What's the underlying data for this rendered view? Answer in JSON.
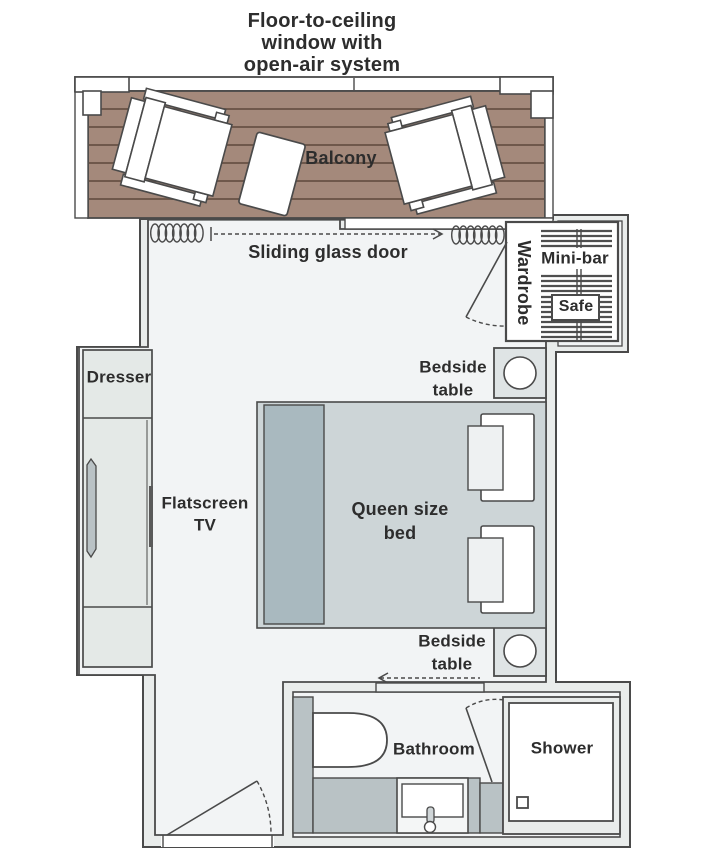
{
  "header": {
    "title_line1": "Floor-to-ceiling",
    "title_line2": "window with",
    "title_line3": "open-air system"
  },
  "labels": {
    "balcony": "Balcony",
    "sliding_door": "Sliding glass door",
    "wardrobe": "Wardrobe",
    "minibar": "Mini-bar",
    "safe": "Safe",
    "dresser": "Dresser",
    "tv_line1": "Flatscreen",
    "tv_line2": "TV",
    "bed_line1": "Queen size",
    "bed_line2": "bed",
    "bedside_line1": "Bedside",
    "bedside_line2": "table",
    "bathroom": "Bathroom",
    "shower": "Shower"
  },
  "colors": {
    "text": "#2d2d2d",
    "wall_line": "#4a4a4a",
    "wall_fill": "#e9eceb",
    "room_fill": "#f2f4f5",
    "deck": "#a4897b",
    "plank_line": "#6f584b",
    "furniture_white": "#ffffff",
    "cabinet_fill": "#e4e9e7",
    "bed_fill": "#cdd5d7",
    "headboard_fill": "#a9b9bf",
    "pillow_inner": "#eef1f2",
    "fixture_gray": "#b9c2c5",
    "bedside_fill": "#dfe4e5"
  }
}
